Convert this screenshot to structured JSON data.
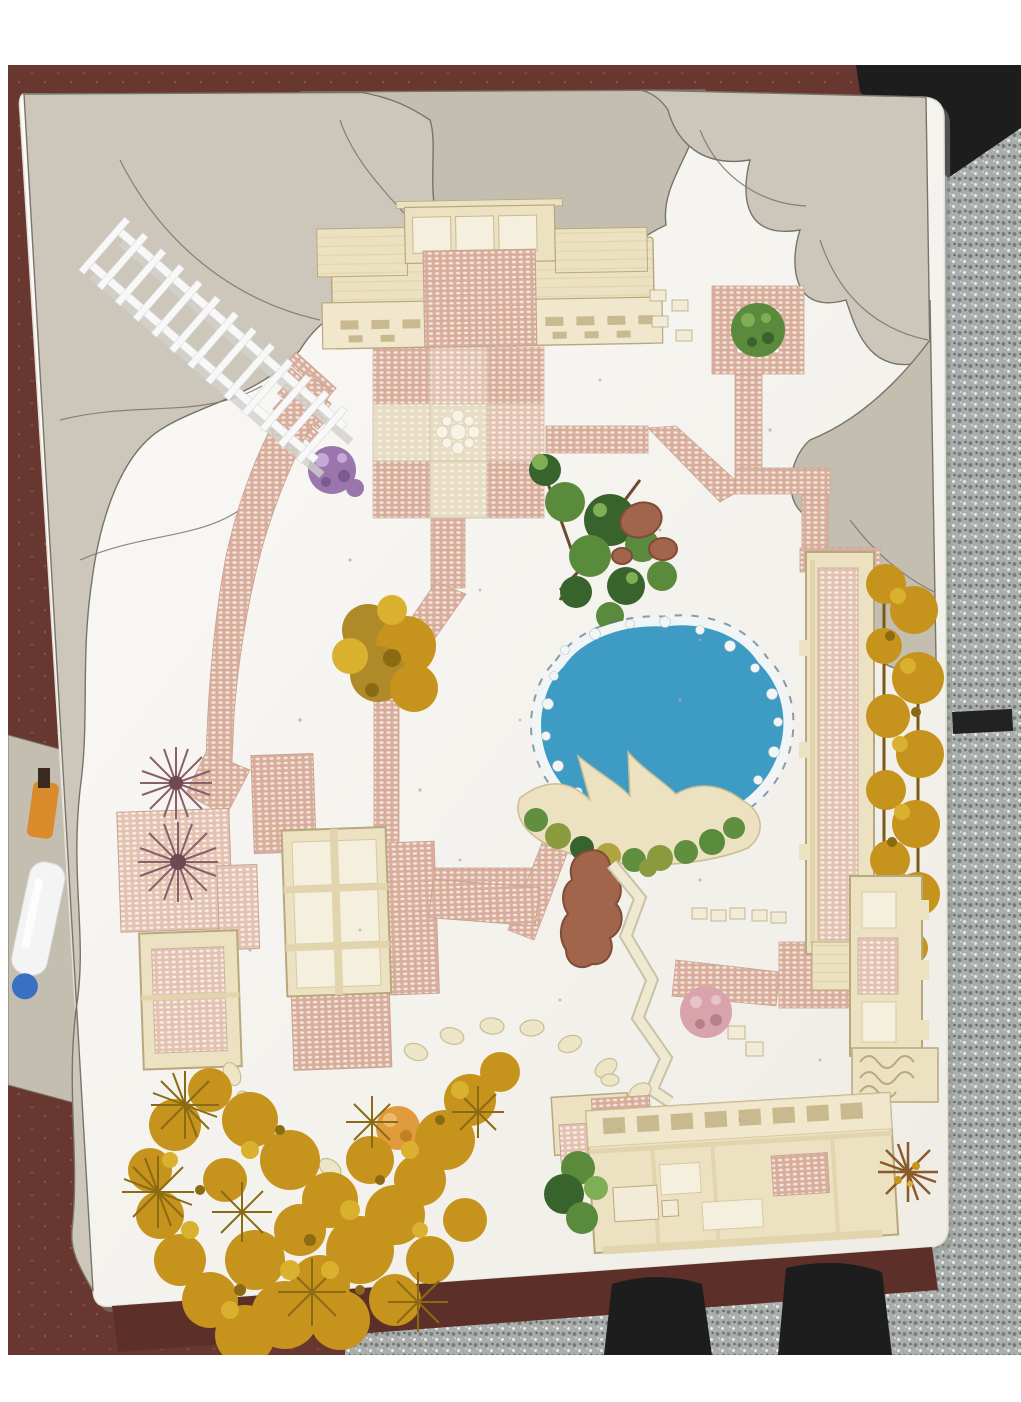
{
  "scene": {
    "description": "Overhead photo of a handmade landscape-architecture garden model (white paper site, grey cardboard mountains, brick-bead paths, blue pond, wooden pavilions, model trees) sitting on a dark red-brown table over a grey terrazzo floor",
    "objects": {
      "board": "white model base board",
      "mountains": "grey cardboard mountain contours",
      "fence": "white picket fence strip",
      "pavilion": "main wooden pavilion (north)",
      "plaza": "checkerboard brick plaza",
      "pond": "blue pond with pebble edge",
      "deck": "wooden waterside deck",
      "corridor_east": "east covered walkway with golden trees",
      "corridor_southeast": "southeast carved corridor",
      "building_west": "west courtyard buildings",
      "building_south": "south long pavilion",
      "paths": "pink brick-bead paths",
      "stones": "stepping-stone trail",
      "trees_gold": "golden model trees",
      "trees_green": "green model trees",
      "bottle": "white glue bottle on table",
      "feet": "photographer's feet on terrazzo floor"
    },
    "palette": {
      "frame": "#ffffff",
      "table": "#683830",
      "table_spot": "#7d4a40",
      "table_edge": "#5c3028",
      "floor_base": "#a9aeac",
      "floor_dark": "#767c7a",
      "floor_deep": "#5f6563",
      "floor_light": "#e9ebe9",
      "black_obj": "#1d1d1d",
      "grey_obj": "#9b9f9d",
      "board1": "#fbfaf8",
      "board2": "#efece5",
      "board_stroke": "#e3dfd5",
      "board_shadow": "#8f948f",
      "cardboard": "#ccc7ba",
      "cardboard2": "#c3beb0",
      "pencil": "#78746a",
      "brick": "#d9ad9c",
      "brick_dot": "#f3e7dd",
      "brick_stroke": "#c8a492",
      "brickL": "#e4c2b2",
      "brickL_dot": "#f7efe7",
      "cream_sq": "#e7dcc4",
      "cream_dot": "#f6efdd",
      "wood": "#ece2c2",
      "wood_line": "#b8a87e",
      "wood_panel": "#f0e7cd",
      "wood_slit": "#c9b98e",
      "wood_open": "#f5efde",
      "wood_beam": "#e2d5ae",
      "pond": "#3d9bc4",
      "ring": "#4a6f8c",
      "pebble": "#f2f5f6",
      "pebble_stroke": "#b9c2c6",
      "moss1": "#5f8f3f",
      "moss2": "#8a9a3e",
      "moss3": "#b0a43c",
      "green": "#5a8a3c",
      "green_dark": "#39632c",
      "green_hi": "#7fae55",
      "gold": "#c6931d",
      "gold_hi": "#dab02f",
      "gold_dark": "#8a6a12",
      "olive": "#b08a28",
      "purple": "#9a76ad",
      "purple_dark": "#7c5a92",
      "purple_hi": "#c5a9d6",
      "maroon": "#8a6068",
      "maroon_dark": "#6e4a50",
      "pink": "#d8a3ab",
      "pink_dark": "#b97f8a",
      "pink_hi": "#e8c3c9",
      "clay": "#a0654a",
      "clay_dark": "#7f4c36",
      "fence": "#f8f8f8",
      "fence_shadow": "#d2d1cc",
      "fence_stroke": "#d8d8d8",
      "stone": "#ece5c6",
      "stone_stroke": "#c9bd93",
      "zig": "#efe9d2",
      "zig_case": "#c9c2a4",
      "orange": "#e09b3d",
      "cap_orange": "#d98a2b",
      "bottle": "#f4f4f4",
      "bottle_cap": "#3a6fc4",
      "speck": "#b1aa9e",
      "bench": "#f1ebd8"
    }
  }
}
